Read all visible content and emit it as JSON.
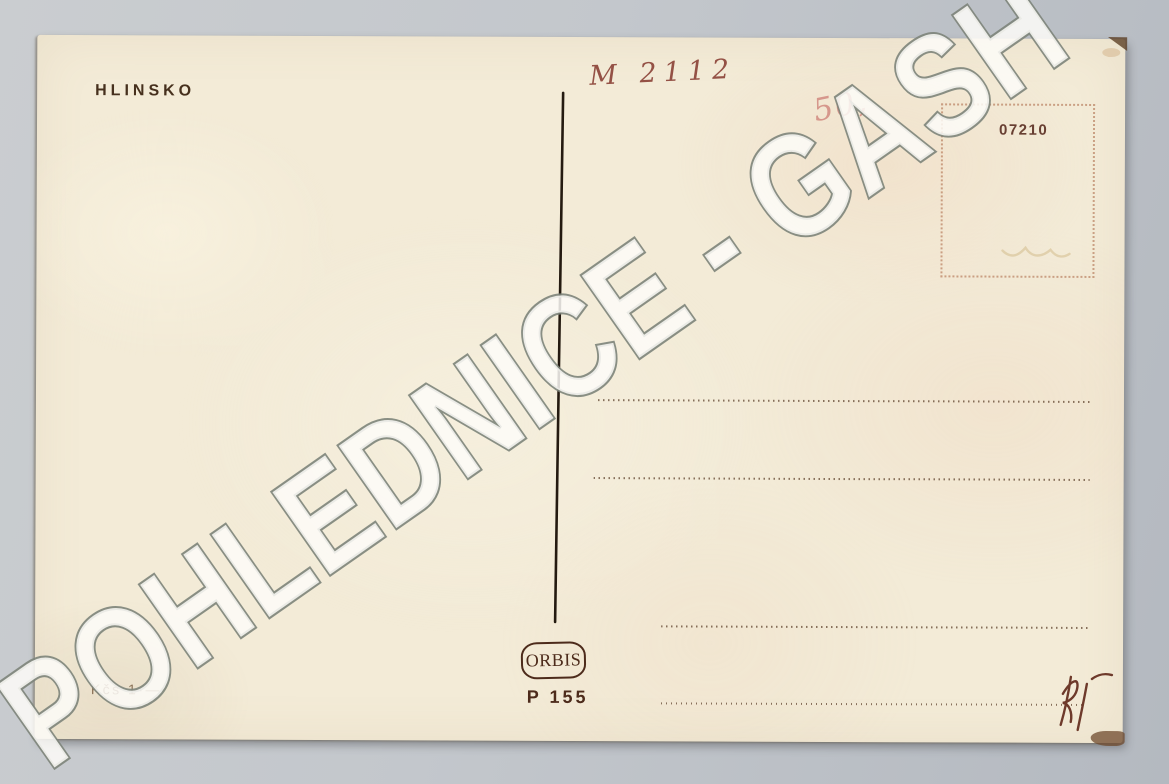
{
  "scene": {
    "background_color": "#c3c7cc",
    "card_color": "#f3ebd7"
  },
  "watermark": {
    "text": "POHLEDNICE - GASH",
    "fill_color": "#fdfcf8",
    "outline_color": "#7d847a"
  },
  "postcard": {
    "location_title": "HLINSKO",
    "handwritten_catalog_number": "M 2112",
    "handwritten_price": "50,",
    "stamp_box": {
      "serial_number": "07210"
    },
    "publisher_badge": "ORBIS",
    "print_code": "P 155",
    "price_imprint": "Kčs 1·—",
    "printed_ink_color": "#46301d",
    "handwriting_ink_color": "#8a4136",
    "price_handwriting_color": "#d28a80"
  }
}
